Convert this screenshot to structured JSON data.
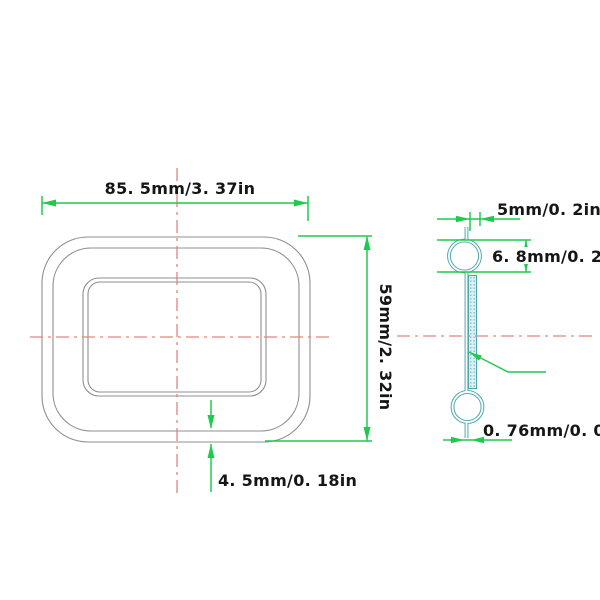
{
  "drawing": {
    "type": "technical-dimension-drawing",
    "front_view": {
      "width_dim_label": "85. 5mm/3. 37in",
      "height_dim_label": "59mm/2. 32in",
      "rim_dim_label": "4. 5mm/0. 18in"
    },
    "side_view": {
      "depth_dim_label": "5mm/0. 2in",
      "hook_dim_label": "6. 8mm/0. 27in",
      "wall_dim_label": "0. 76mm/0. 03in"
    },
    "colors": {
      "dimension_green": "#1fcb4e",
      "centerline_red": "#e2867c",
      "profile_teal": "#4aa4ac",
      "profile_inner_white": "#f9fdfd",
      "outline_gray": "#8f8f8f",
      "label_black": "#161616",
      "background": "#ffffff"
    }
  }
}
